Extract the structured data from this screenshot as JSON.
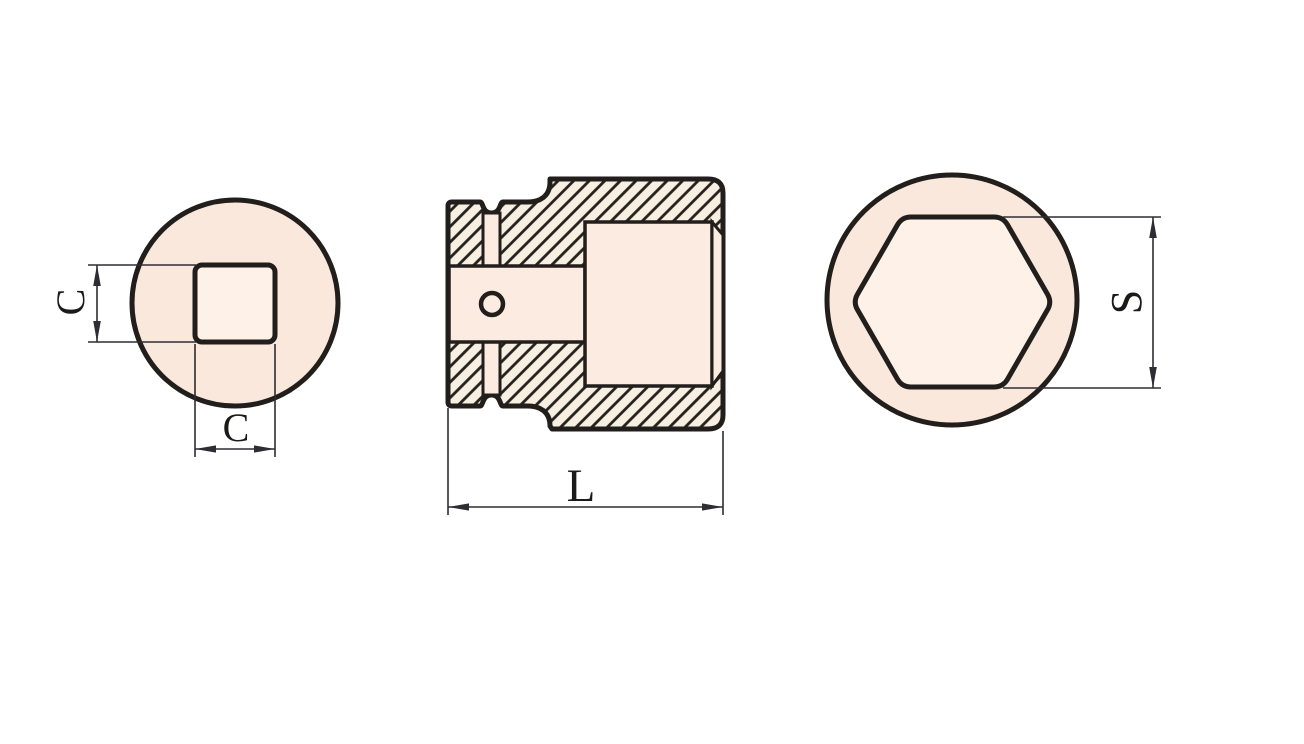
{
  "drawing": {
    "title": "impact socket technical drawing",
    "views": {
      "front": {
        "vertical_dim": "C",
        "horizontal_dim": "C"
      },
      "section": {
        "length_dim": "L"
      },
      "hex_end": {
        "across_flats_dim": "S"
      }
    },
    "colors": {
      "line": "#211e1b",
      "dim_line": "#2e2d33",
      "peach_fill": "#fae8dc",
      "inner_fill": "#fdf1e8",
      "hatch_bg": "#f8efe3",
      "recess_fill": "#fcebe1",
      "background": "#ffffff"
    }
  }
}
